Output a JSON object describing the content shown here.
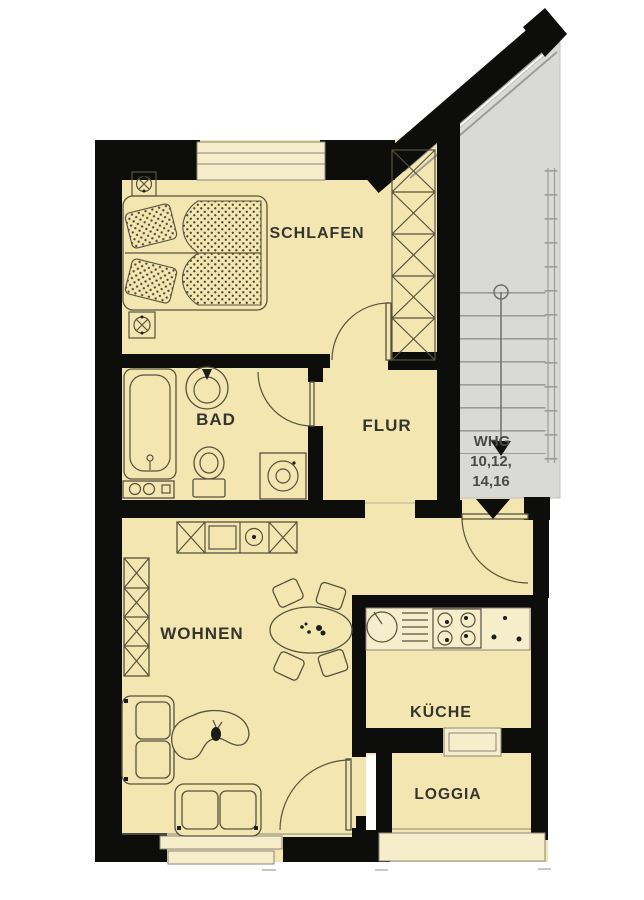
{
  "rooms": {
    "schlafen": "SCHLAFEN",
    "bad": "BAD",
    "flur": "FLUR",
    "wohnen": "WOHNEN",
    "kueche": "KÜCHE",
    "loggia": "LOGGIA"
  },
  "stairwell": {
    "line1": "WHG",
    "line2": "10,12,",
    "line3": "14,16"
  },
  "icons": {
    "entrance_arrow": "filled-triangle-down",
    "stair_direction": "arrow-down-with-circle",
    "bed_sockets": "crosshair-square"
  },
  "colors": {
    "wall_color": "#0d0d0b",
    "room_fill": "#f3e6b0",
    "counter_fill": "#f6eecb",
    "stair_gray": "#d9d9d6",
    "outline": "#57523f",
    "label_color": "#35342e",
    "stair_label_color": "#4a4a46",
    "stair_lines": "#9d9d99"
  }
}
